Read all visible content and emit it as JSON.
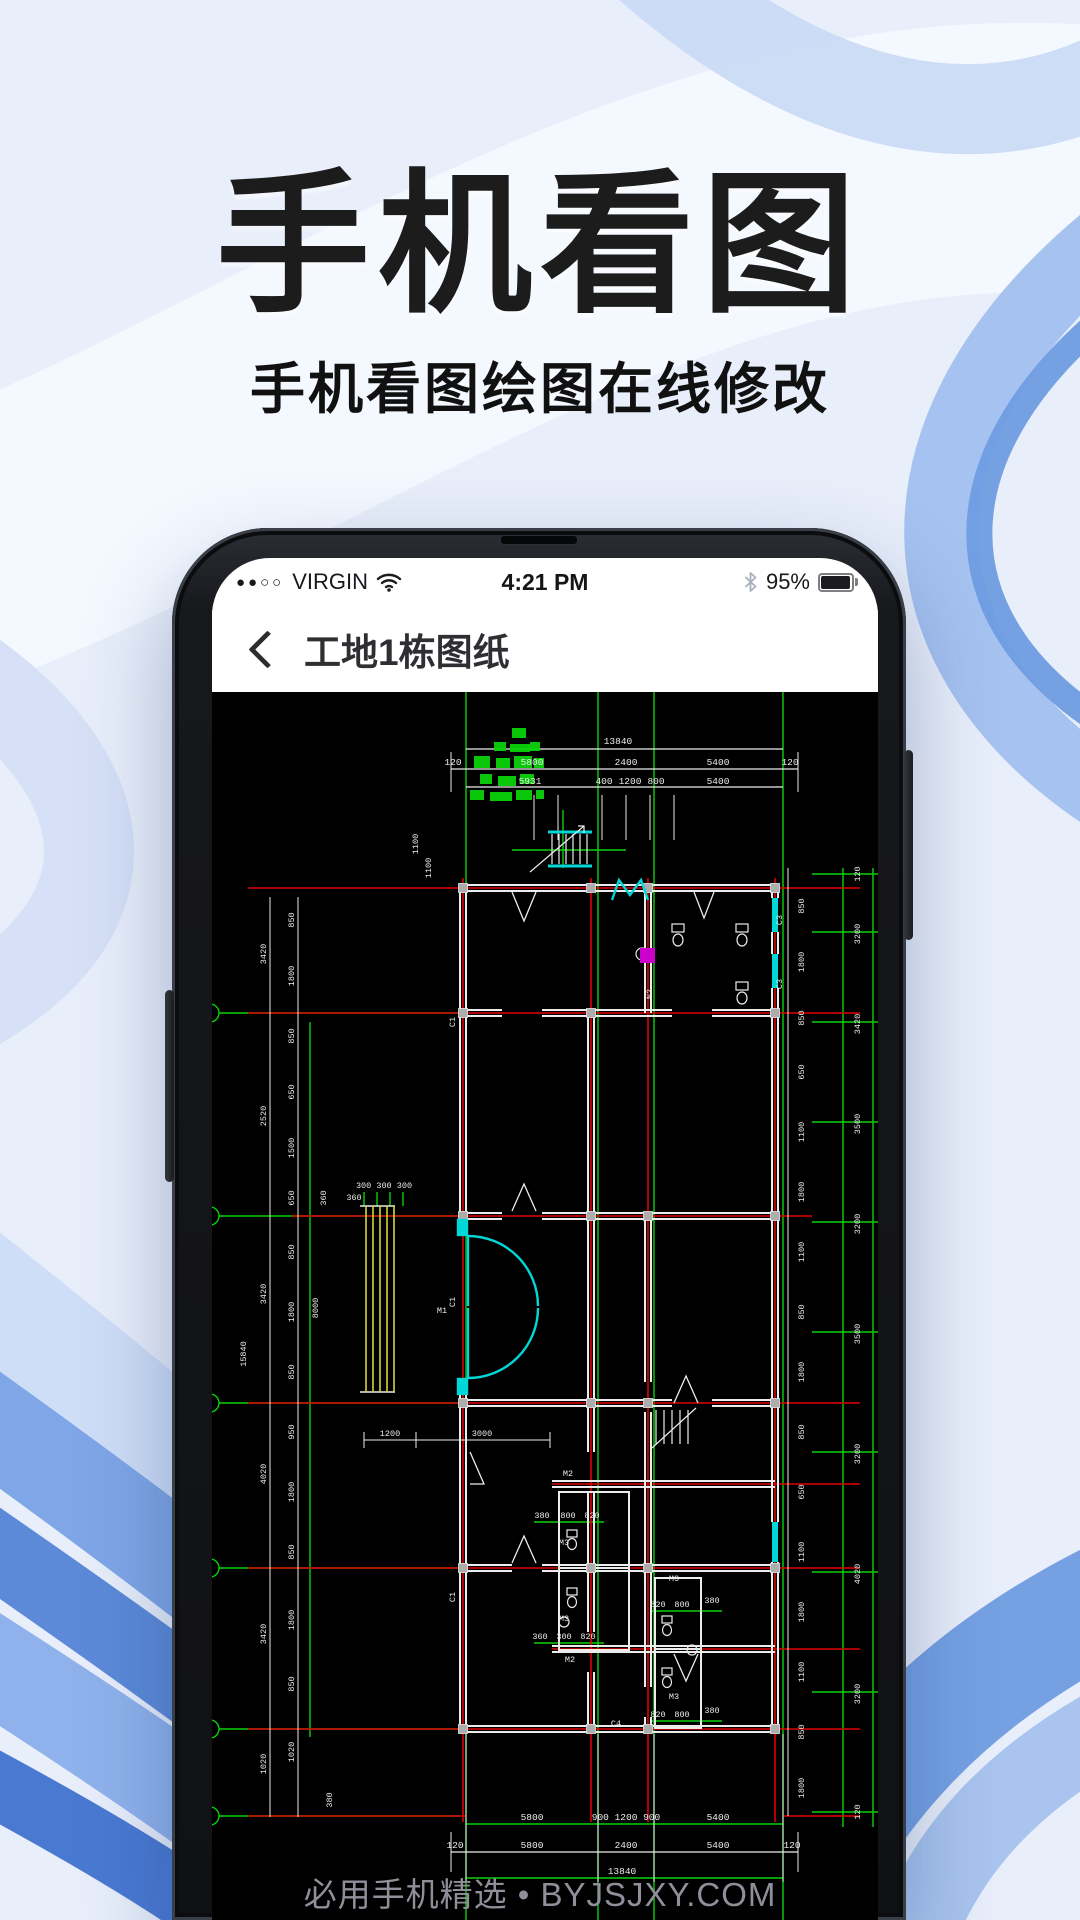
{
  "hero": {
    "title": "手机看图",
    "subtitle": "手机看图绘图在线修改"
  },
  "phone": {
    "status": {
      "signal_dots": "●●○○",
      "carrier": "VIRGIN",
      "time": "4:21 PM",
      "battery_pct": "95%"
    },
    "nav": {
      "title": "工地1栋图纸"
    }
  },
  "watermark": "必用手机精选 • BYJSJXY.COM",
  "cad": {
    "colors": {
      "bg": "#000000",
      "grid_green": "#0ad10a",
      "center_red": "#e00000",
      "wall_white": "#ececec",
      "door_cyan": "#00d8d8",
      "hatch_yellow": "#d8d23e",
      "accent_magenta": "#cc00cc",
      "column_gray": "#adadad",
      "watermark_gray": "#8f8f9a"
    },
    "dims_top": [
      {
        "t": "13840",
        "x": 406,
        "y": 52
      },
      {
        "t": "120",
        "x": 241,
        "y": 73
      },
      {
        "t": "5800",
        "x": 320,
        "y": 73
      },
      {
        "t": "2400",
        "x": 414,
        "y": 73
      },
      {
        "t": "5400",
        "x": 506,
        "y": 73
      },
      {
        "t": "120",
        "x": 578,
        "y": 73
      },
      {
        "t": "5931",
        "x": 318,
        "y": 92
      },
      {
        "t": "400",
        "x": 392,
        "y": 92
      },
      {
        "t": "1200",
        "x": 418,
        "y": 92
      },
      {
        "t": "800",
        "x": 444,
        "y": 92
      },
      {
        "t": "5400",
        "x": 506,
        "y": 92
      }
    ],
    "dims_bottom": [
      {
        "t": "5800",
        "x": 320,
        "y": 1128
      },
      {
        "t": "900 1200 900",
        "x": 414,
        "y": 1128
      },
      {
        "t": "5400",
        "x": 506,
        "y": 1128
      },
      {
        "t": "120",
        "x": 243,
        "y": 1156
      },
      {
        "t": "5800",
        "x": 320,
        "y": 1156
      },
      {
        "t": "2400",
        "x": 414,
        "y": 1156
      },
      {
        "t": "5400",
        "x": 506,
        "y": 1156
      },
      {
        "t": "120",
        "x": 580,
        "y": 1156
      },
      {
        "t": "13840",
        "x": 410,
        "y": 1182
      }
    ],
    "dims_left": [
      {
        "t": "3420",
        "x": 54,
        "y": 262,
        "rot": 1
      },
      {
        "t": "2520",
        "x": 54,
        "y": 424,
        "rot": 1
      },
      {
        "t": "3420",
        "x": 54,
        "y": 602,
        "rot": 1
      },
      {
        "t": "15840",
        "x": 34,
        "y": 662,
        "rot": 1
      },
      {
        "t": "4020",
        "x": 54,
        "y": 782,
        "rot": 1
      },
      {
        "t": "3420",
        "x": 54,
        "y": 942,
        "rot": 1
      },
      {
        "t": "1020",
        "x": 54,
        "y": 1072,
        "rot": 1
      },
      {
        "t": "850",
        "x": 82,
        "y": 228,
        "rot": 1
      },
      {
        "t": "1800",
        "x": 82,
        "y": 284,
        "rot": 1
      },
      {
        "t": "850",
        "x": 82,
        "y": 344,
        "rot": 1
      },
      {
        "t": "650",
        "x": 82,
        "y": 400,
        "rot": 1
      },
      {
        "t": "1500",
        "x": 82,
        "y": 456,
        "rot": 1
      },
      {
        "t": "650",
        "x": 82,
        "y": 506,
        "rot": 1
      },
      {
        "t": "850",
        "x": 82,
        "y": 560,
        "rot": 1
      },
      {
        "t": "1800",
        "x": 82,
        "y": 620,
        "rot": 1
      },
      {
        "t": "850",
        "x": 82,
        "y": 680,
        "rot": 1
      },
      {
        "t": "950",
        "x": 82,
        "y": 740,
        "rot": 1
      },
      {
        "t": "1800",
        "x": 82,
        "y": 800,
        "rot": 1
      },
      {
        "t": "850",
        "x": 82,
        "y": 860,
        "rot": 1
      },
      {
        "t": "1800",
        "x": 82,
        "y": 928,
        "rot": 1
      },
      {
        "t": "850",
        "x": 82,
        "y": 992,
        "rot": 1
      },
      {
        "t": "1020",
        "x": 82,
        "y": 1060,
        "rot": 1
      },
      {
        "t": "8000",
        "x": 106,
        "y": 616,
        "rot": 1
      },
      {
        "t": "360",
        "x": 114,
        "y": 506,
        "rot": 1
      },
      {
        "t": "380",
        "x": 120,
        "y": 1108,
        "rot": 1
      }
    ],
    "dims_right": [
      {
        "t": "120",
        "x": 648,
        "y": 182,
        "rot": 1
      },
      {
        "t": "3200",
        "x": 648,
        "y": 242,
        "rot": 1
      },
      {
        "t": "3420",
        "x": 648,
        "y": 332,
        "rot": 1
      },
      {
        "t": "3500",
        "x": 648,
        "y": 432,
        "rot": 1
      },
      {
        "t": "3200",
        "x": 648,
        "y": 532,
        "rot": 1
      },
      {
        "t": "3500",
        "x": 648,
        "y": 642,
        "rot": 1
      },
      {
        "t": "3200",
        "x": 648,
        "y": 762,
        "rot": 1
      },
      {
        "t": "4020",
        "x": 648,
        "y": 882,
        "rot": 1
      },
      {
        "t": "3200",
        "x": 648,
        "y": 1002,
        "rot": 1
      },
      {
        "t": "120",
        "x": 648,
        "y": 1120,
        "rot": 1
      },
      {
        "t": "850",
        "x": 592,
        "y": 214,
        "rot": 1
      },
      {
        "t": "1800",
        "x": 592,
        "y": 270,
        "rot": 1
      },
      {
        "t": "850",
        "x": 592,
        "y": 326,
        "rot": 1
      },
      {
        "t": "650",
        "x": 592,
        "y": 380,
        "rot": 1
      },
      {
        "t": "1100",
        "x": 592,
        "y": 440,
        "rot": 1
      },
      {
        "t": "1800",
        "x": 592,
        "y": 500,
        "rot": 1
      },
      {
        "t": "1100",
        "x": 592,
        "y": 560,
        "rot": 1
      },
      {
        "t": "850",
        "x": 592,
        "y": 620,
        "rot": 1
      },
      {
        "t": "1800",
        "x": 592,
        "y": 680,
        "rot": 1
      },
      {
        "t": "850",
        "x": 592,
        "y": 740,
        "rot": 1
      },
      {
        "t": "650",
        "x": 592,
        "y": 800,
        "rot": 1
      },
      {
        "t": "1100",
        "x": 592,
        "y": 860,
        "rot": 1
      },
      {
        "t": "1800",
        "x": 592,
        "y": 920,
        "rot": 1
      },
      {
        "t": "1100",
        "x": 592,
        "y": 980,
        "rot": 1
      },
      {
        "t": "850",
        "x": 592,
        "y": 1040,
        "rot": 1
      },
      {
        "t": "1800",
        "x": 592,
        "y": 1096,
        "rot": 1
      }
    ],
    "labels": [
      {
        "t": "M1",
        "x": 230,
        "y": 621
      },
      {
        "t": "M2",
        "x": 356,
        "y": 784
      },
      {
        "t": "M2",
        "x": 358,
        "y": 970
      },
      {
        "t": "M3",
        "x": 352,
        "y": 853
      },
      {
        "t": "M3",
        "x": 352,
        "y": 929
      },
      {
        "t": "M3",
        "x": 462,
        "y": 889
      },
      {
        "t": "M3",
        "x": 462,
        "y": 1007
      },
      {
        "t": "C4",
        "x": 404,
        "y": 1034
      },
      {
        "t": "C1",
        "x": 243,
        "y": 330,
        "rot": 1
      },
      {
        "t": "C1",
        "x": 243,
        "y": 610,
        "rot": 1
      },
      {
        "t": "C1",
        "x": 243,
        "y": 905,
        "rot": 1
      },
      {
        "t": "C3",
        "x": 570,
        "y": 228,
        "rot": 1
      },
      {
        "t": "C3",
        "x": 570,
        "y": 292,
        "rot": 1
      },
      {
        "t": "N2",
        "x": 440,
        "y": 302,
        "rot": 1
      },
      {
        "t": "1100",
        "x": 206,
        "y": 152,
        "rot": 1
      },
      {
        "t": "1100",
        "x": 219,
        "y": 176,
        "rot": 1
      },
      {
        "t": "1200",
        "x": 178,
        "y": 744
      },
      {
        "t": "3000",
        "x": 270,
        "y": 744
      },
      {
        "t": "300 300 300",
        "x": 172,
        "y": 496
      },
      {
        "t": "360",
        "x": 142,
        "y": 508
      },
      {
        "t": "380",
        "x": 330,
        "y": 826
      },
      {
        "t": "800",
        "x": 356,
        "y": 826
      },
      {
        "t": "820",
        "x": 380,
        "y": 826
      },
      {
        "t": "360",
        "x": 328,
        "y": 947
      },
      {
        "t": "300",
        "x": 352,
        "y": 947
      },
      {
        "t": "820",
        "x": 376,
        "y": 947
      },
      {
        "t": "820",
        "x": 446,
        "y": 915
      },
      {
        "t": "800",
        "x": 470,
        "y": 915
      },
      {
        "t": "380",
        "x": 500,
        "y": 911
      },
      {
        "t": "820",
        "x": 446,
        "y": 1025
      },
      {
        "t": "800",
        "x": 470,
        "y": 1025
      },
      {
        "t": "380",
        "x": 500,
        "y": 1021
      }
    ]
  }
}
